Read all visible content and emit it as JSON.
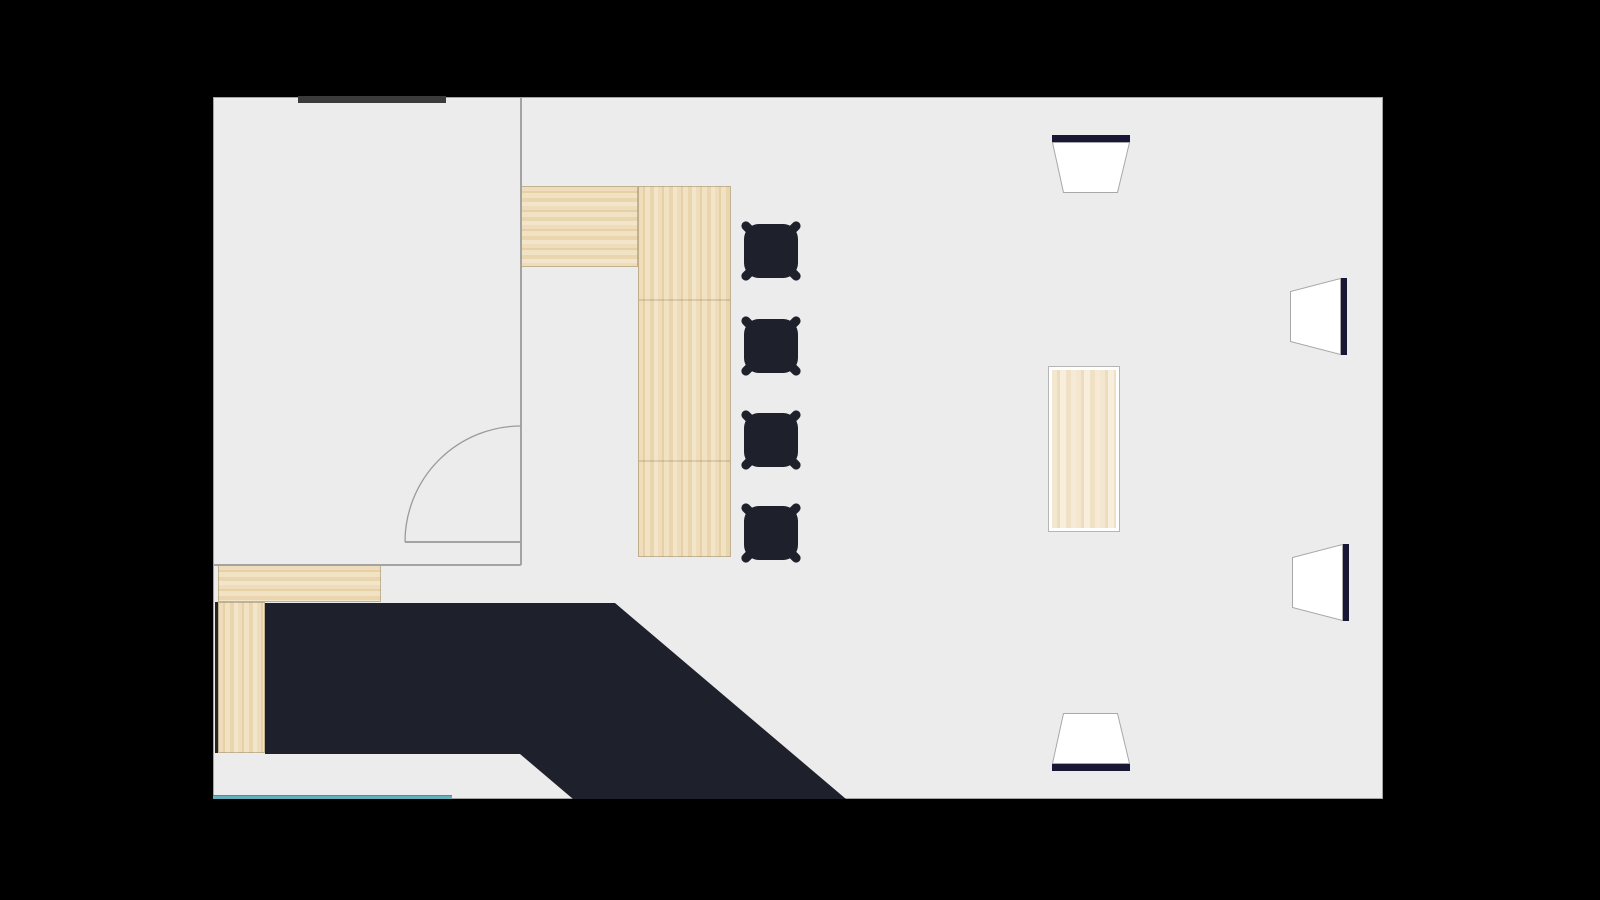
{
  "scene": {
    "background": "#000000",
    "floor_color": "#ececec",
    "wall_line_color": "#a3a3a3",
    "dark_wall_color": "#3b3b3b",
    "dark_surface_color": "#1e212b",
    "speaker_bar_color": "#181735",
    "speaker_body_color": "#ffffff",
    "speaker_outline_color": "#a8a8a8",
    "window_color": "#65afbc",
    "window_edge_color": "#47909f"
  },
  "plan": {
    "x": 213,
    "y": 97,
    "width": 1170,
    "height": 702
  },
  "walls": {
    "top_dark_segment": {
      "x": 298,
      "y": 96,
      "width": 148,
      "height": 7
    },
    "inner_vertical_wall": {
      "x": 520,
      "y": 97,
      "width": 2,
      "height": 468
    },
    "lower_room_wall": {
      "x": 213,
      "y": 564,
      "width": 308,
      "height": 2
    },
    "service_wall_strip": {
      "x": 215,
      "y": 602,
      "width": 3,
      "height": 151
    }
  },
  "door": {
    "arc": {
      "x": 405,
      "y": 426,
      "size": 116
    },
    "leaf": {
      "x": 405,
      "y": 541,
      "width": 116,
      "height": 2
    }
  },
  "bar_counter": {
    "horizontal_section": {
      "x": 520,
      "y": 186,
      "width": 118,
      "height": 81
    },
    "vertical_section": {
      "x": 638,
      "y": 186,
      "width": 93,
      "height": 371
    },
    "seam_offsets": [
      112,
      273
    ]
  },
  "service_counter": {
    "horizontal_section": {
      "x": 218,
      "y": 565,
      "width": 163,
      "height": 37
    },
    "vertical_section": {
      "x": 218,
      "y": 602,
      "width": 47,
      "height": 151
    }
  },
  "stage": {
    "x": 265,
    "y": 603,
    "width": 581,
    "height": 196,
    "points": "0,0 350,0 581,196 308,196 255,151 0,151"
  },
  "window_sill": {
    "x": 213,
    "y": 795,
    "width": 239,
    "height": 4
  },
  "table": {
    "x": 1048,
    "y": 366,
    "width": 72,
    "height": 166
  },
  "stool_size": 74,
  "stools": [
    {
      "x": 734,
      "y": 214
    },
    {
      "x": 734,
      "y": 309
    },
    {
      "x": 734,
      "y": 403
    },
    {
      "x": 734,
      "y": 496
    }
  ],
  "speakers": [
    {
      "x": 1052,
      "y": 135,
      "width": 78,
      "height": 58,
      "orientation": "down"
    },
    {
      "x": 1290,
      "y": 278,
      "width": 57,
      "height": 77,
      "orientation": "left"
    },
    {
      "x": 1292,
      "y": 544,
      "width": 57,
      "height": 77,
      "orientation": "left"
    },
    {
      "x": 1052,
      "y": 713,
      "width": 78,
      "height": 58,
      "orientation": "up"
    }
  ]
}
